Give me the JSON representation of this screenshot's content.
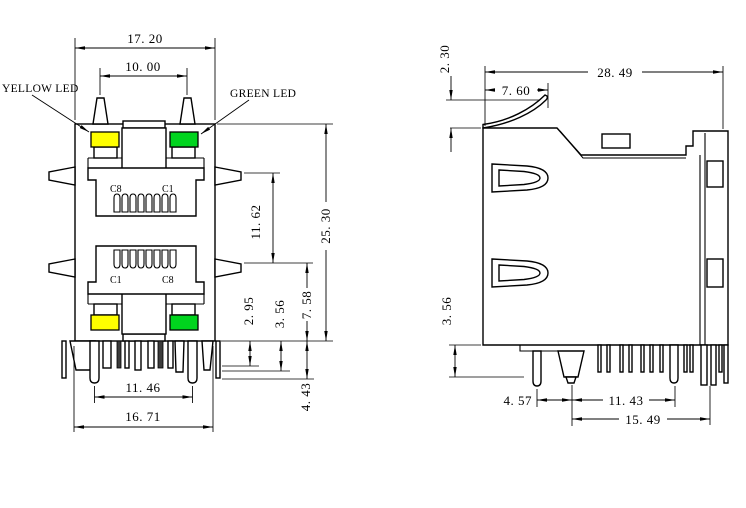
{
  "drawing_type": "RJ45 stacked modular jack dimensional drawing",
  "colors": {
    "yellow": "#ffff00",
    "green": "#00d41e",
    "line": "#000000",
    "background": "#ffffff"
  },
  "front_view": {
    "leds": {
      "yellow_label": "YELLOW LED",
      "green_label": "GREEN LED"
    },
    "ports": {
      "port1": {
        "left_contact": "C8",
        "right_contact": "C1"
      },
      "port2": {
        "left_contact": "C1",
        "right_contact": "C8"
      }
    },
    "dims": {
      "body_width": "17. 20",
      "led_post_spacing": "10. 00",
      "latch_pitch": "11. 62",
      "overall_height": "25. 30",
      "standoff_a": "2. 95",
      "standoff_b": "3. 56",
      "lower_latch_to_base": "7. 58",
      "pin_length": "4. 43",
      "pin_span": "11. 46",
      "base_width": "16. 71"
    }
  },
  "side_view": {
    "dims": {
      "finger_height": "2. 30",
      "overall_depth": "28. 49",
      "finger_length": "7. 60",
      "standoff": "3. 56",
      "pin_pitch_a": "4. 57",
      "pin_pitch_b": "11. 43",
      "pin_pitch_c": "15. 49"
    }
  }
}
